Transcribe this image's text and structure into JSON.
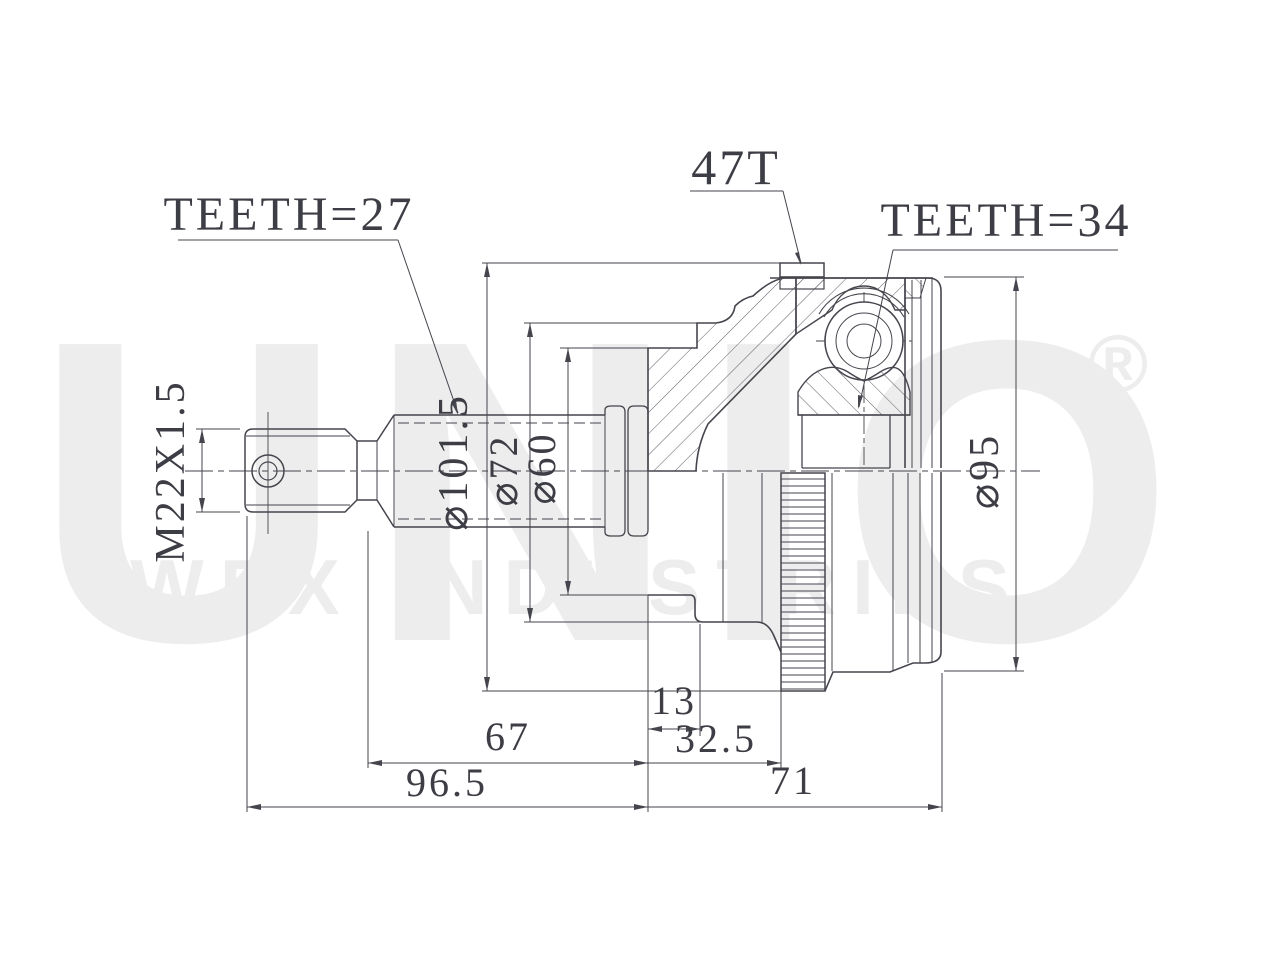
{
  "watermark": {
    "brand": "UNIO",
    "registered": "®",
    "subtitle": "WEX INDUSTRIES"
  },
  "callouts": {
    "shaft_spline_teeth": "TEETH=27",
    "abs_ring_teeth": "47T",
    "joint_spline_teeth": "TEETH=34"
  },
  "dimensions": {
    "thread_spec": "M22X1.5",
    "abs_ring_outer_dia": "⌀101.5",
    "boot_groove_large_dia": "⌀72",
    "boot_groove_small_dia": "⌀60",
    "race_outer_dia": "⌀95",
    "ring_offset": "13",
    "face_to_ring": "32.5",
    "shaft_length": "67",
    "shaft_overall_length": "96.5",
    "joint_width": "71"
  },
  "colors": {
    "line": "#45454d",
    "text": "#3d3d45",
    "hatch": "#5d5d66",
    "watermark": "#ededed",
    "background": "#ffffff"
  }
}
